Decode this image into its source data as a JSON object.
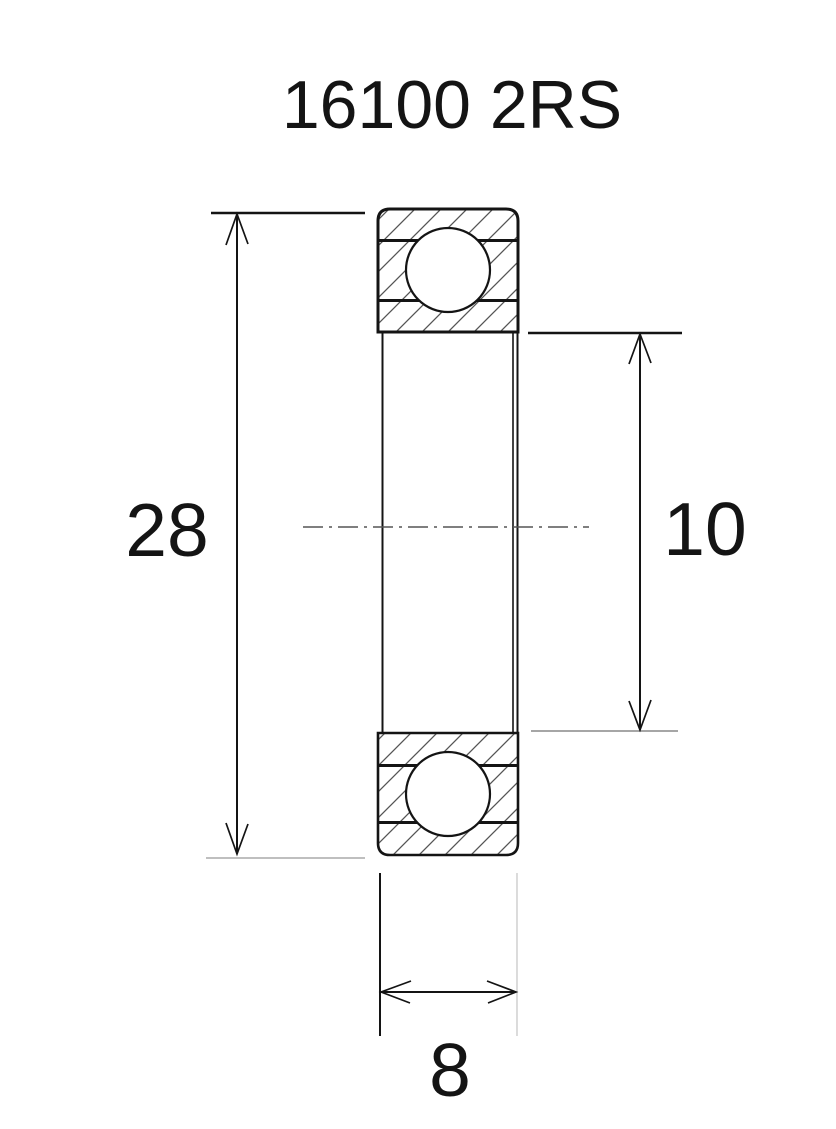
{
  "title": "16100 2RS",
  "dimensions": {
    "outer_diameter": "28",
    "bore_diameter": "10",
    "width": "8"
  },
  "colors": {
    "line": "#141414",
    "hatch": "#555555",
    "faint_line": "#aaaaaa",
    "background": "#ffffff"
  }
}
